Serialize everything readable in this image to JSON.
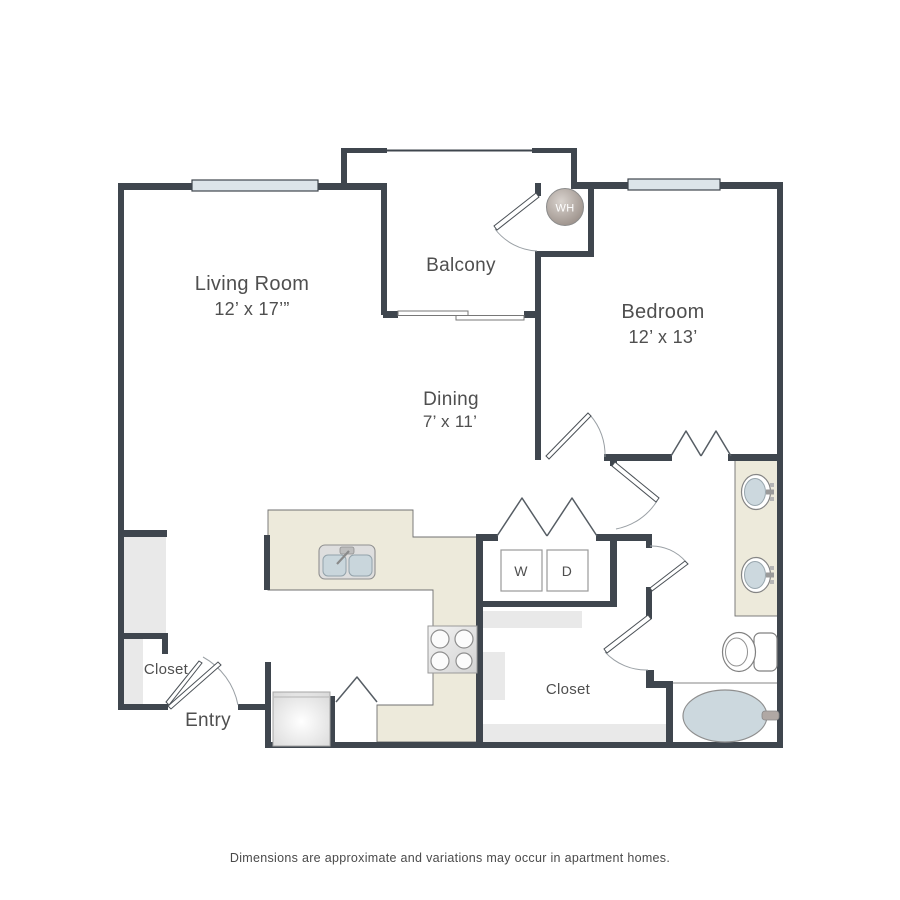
{
  "colors": {
    "wall": "#3f464e",
    "label_text": "#4f4f4f",
    "counter": "#edeadb",
    "shelf": "#e9e9e9",
    "window": "#dce4e9",
    "water_blue": "#ccd8de",
    "door_line": "#4a5056",
    "arc_line": "#9aa0a5",
    "footer_text": "#4a4a4a"
  },
  "rooms": {
    "living_room": {
      "name": "Living Room",
      "dims": "12’ x 17’”"
    },
    "balcony": {
      "name": "Balcony"
    },
    "bedroom": {
      "name": "Bedroom",
      "dims": "12’ x 13’"
    },
    "dining": {
      "name": "Dining",
      "dims": "7’ x 11’"
    },
    "entry": {
      "name": "Entry"
    },
    "entry_closet": {
      "name": "Closet"
    },
    "walk_in_closet": {
      "name": "Closet"
    }
  },
  "appliances": {
    "washer": "W",
    "dryer": "D",
    "water_heater": "WH"
  },
  "footer": {
    "disclaimer": "Dimensions are approximate and variations may occur in apartment homes."
  }
}
